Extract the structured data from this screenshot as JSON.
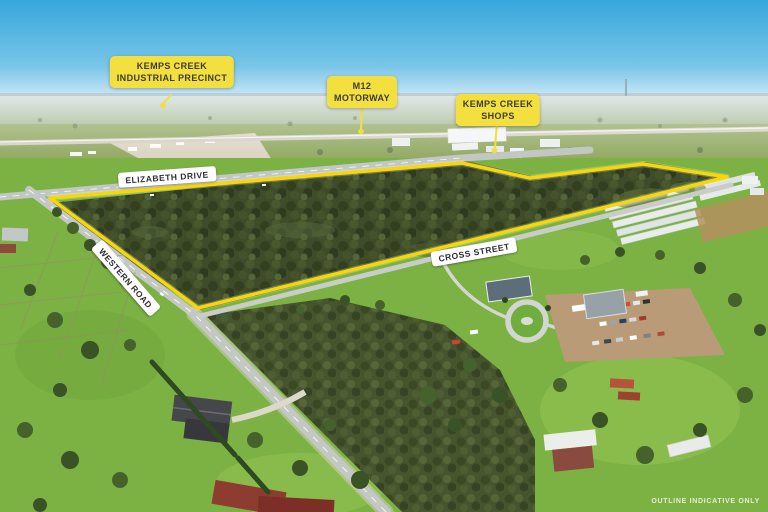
{
  "callouts": {
    "industrial_precinct": {
      "line1": "KEMPS CREEK",
      "line2": "INDUSTRIAL PRECINCT"
    },
    "m12_motorway": {
      "line1": "M12",
      "line2": "MOTORWAY"
    },
    "kemps_creek_shops": {
      "line1": "KEMPS CREEK",
      "line2": "SHOPS"
    }
  },
  "road_labels": {
    "elizabeth_drive": "ELIZABETH DRIVE",
    "western_road": "WESTERN ROAD",
    "cross_street": "CROSS STREET"
  },
  "watermark": "OUTLINE INDICATIVE ONLY",
  "colors": {
    "outline_yellow": "#f8d703",
    "callout_yellow": "#f3df3e",
    "callout_text": "#3e3d34",
    "road_label_bg": "#ffffff",
    "road_label_text": "#2e2e36",
    "sky_blue": "#3aa9dc",
    "forest_green": "#3e4c2a",
    "grass_green": "#7cb143"
  }
}
